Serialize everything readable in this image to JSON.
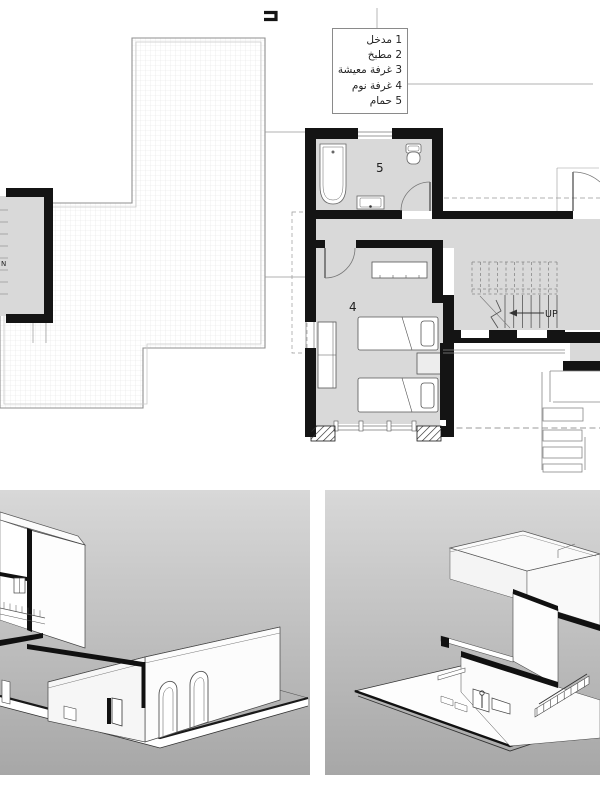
{
  "plan": {
    "legend": {
      "items": [
        {
          "text": "1 مدخل"
        },
        {
          "text": "2 مطبخ"
        },
        {
          "text": "3 غرفة معيشة"
        },
        {
          "text": "4 غرفة نوم"
        },
        {
          "text": "5 حمام"
        }
      ]
    },
    "labels": {
      "bathroom_number": "5",
      "bedroom_number": "4",
      "stair_direction": "UP",
      "left_room_fragment": "N"
    }
  },
  "colors": {
    "wall": "#141414",
    "floor": "#d9d9d9",
    "grid_line": "#e4e4e4",
    "parapet_outline": "#8f8f8f",
    "dashed_line": "#999999",
    "furniture_outline": "#555555",
    "panel_gradient_top": "#d8d8d8",
    "panel_gradient_bottom": "#a7a7a7"
  }
}
